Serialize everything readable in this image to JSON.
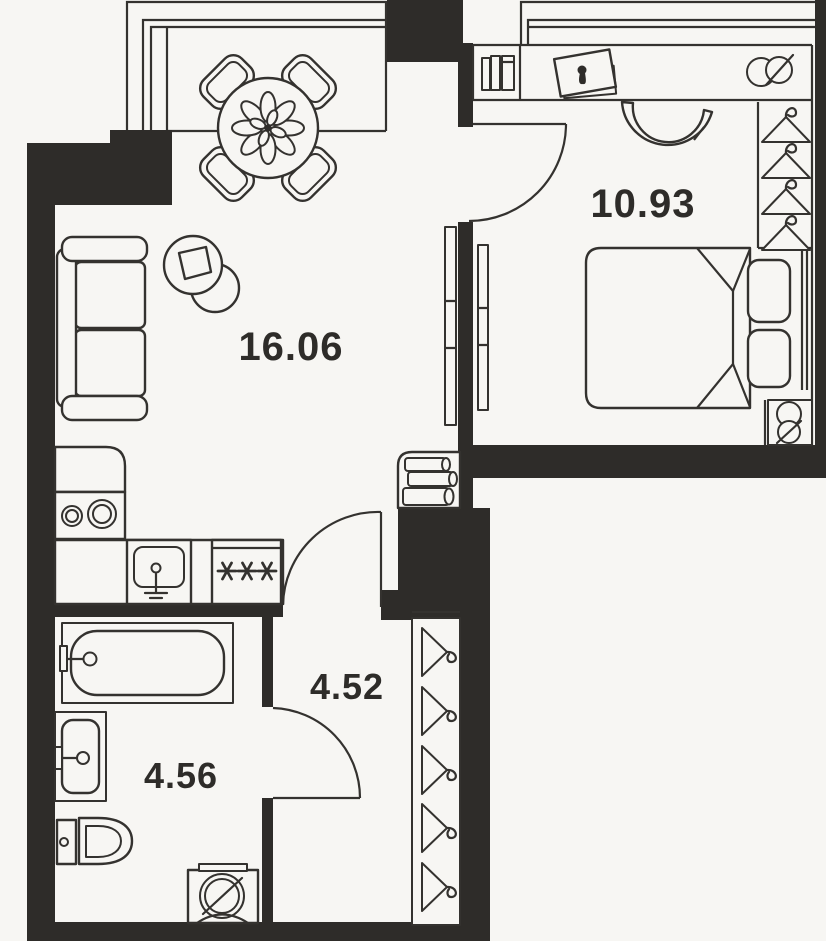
{
  "title": "Apartment floor plan",
  "colors": {
    "background": "#f7f6f3",
    "wall": "#2e2c29",
    "line": "#34322f",
    "label": "#2e2c29"
  },
  "rooms": [
    {
      "name": "living-room",
      "area_label": "16.06"
    },
    {
      "name": "bedroom",
      "area_label": "10.93"
    },
    {
      "name": "hallway",
      "area_label": "4.52"
    },
    {
      "name": "bathroom",
      "area_label": "4.56"
    }
  ],
  "furniture": {
    "living_room": [
      "dining-table",
      "dining-chairs-x4",
      "flower-centerpiece",
      "sofa",
      "side-table",
      "tv-unit",
      "corner-bookshelf"
    ],
    "kitchen_zone": [
      "kitchen-counter",
      "stove-two-burners",
      "kitchen-sink-with-faucet",
      "hob-three-asterisks"
    ],
    "bedroom": [
      "desk-shelf",
      "standing-books",
      "picture-frame-with-keyhole",
      "double-mirror",
      "desk-chair",
      "double-bed",
      "pillows-x2",
      "wardrobe-4-hangers",
      "stool-figure-eight",
      "window-double-line"
    ],
    "hallway": [
      "wardrobe-5-hangers"
    ],
    "bathroom": [
      "bathtub-with-faucet",
      "washbasin-with-faucet",
      "toilet-with-tank",
      "washing-machine"
    ]
  },
  "architecture": [
    "exterior-walls",
    "interior-partitions",
    "balcony-left",
    "balcony-right",
    "swing-door-bedroom",
    "swing-door-hallway",
    "swing-door-bathroom"
  ]
}
